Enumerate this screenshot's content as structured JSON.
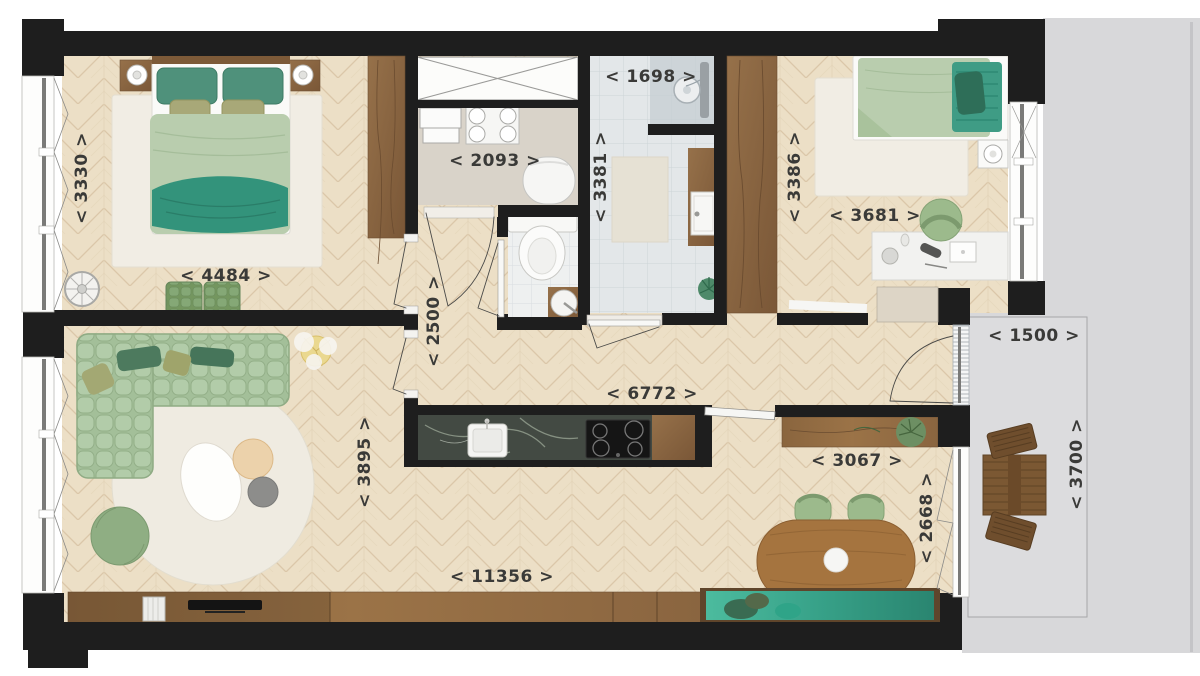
{
  "labels": {
    "bedroom1_width": "< 3330 >",
    "bedroom1_length": "< 4484 >",
    "storage_width": "< 2093 >",
    "bathroom_width": "< 1698 >",
    "bathroom_length": "< 3381 >",
    "bedroom2_width": "< 3386 >",
    "bedroom2_length": "< 3681 >",
    "hallway_width": "< 2500 >",
    "hallway_length": "< 6772 >",
    "balcony_width": "< 1500 >",
    "balcony_length": "< 3700 >",
    "dining_width": "< 3067 >",
    "dining_length": "< 2668 >",
    "living_width": "< 3895 >",
    "living_length": "< 11356 >"
  },
  "colors": {
    "wall": "#1e1e1e",
    "floor_wood": "#ecdfc6",
    "floor_wood_line": "#dbc7a9",
    "storage_floor": "#d9d3c9",
    "tile_bathroom": "#e3e7e9",
    "tile_wc": "#eef0f0",
    "balcony_concrete": "#d8d8da",
    "rug_white": "#f1ede4",
    "furniture_sage": "#aec8a5",
    "pillow_teal": "#4f917b",
    "throw_teal": "#33937b",
    "bench_teal": "#3aaa8e",
    "wood_dark": "#8a6644",
    "wood_table": "#a5743f",
    "counter_marble": "#434a43",
    "label_text": "#3a3a38"
  }
}
